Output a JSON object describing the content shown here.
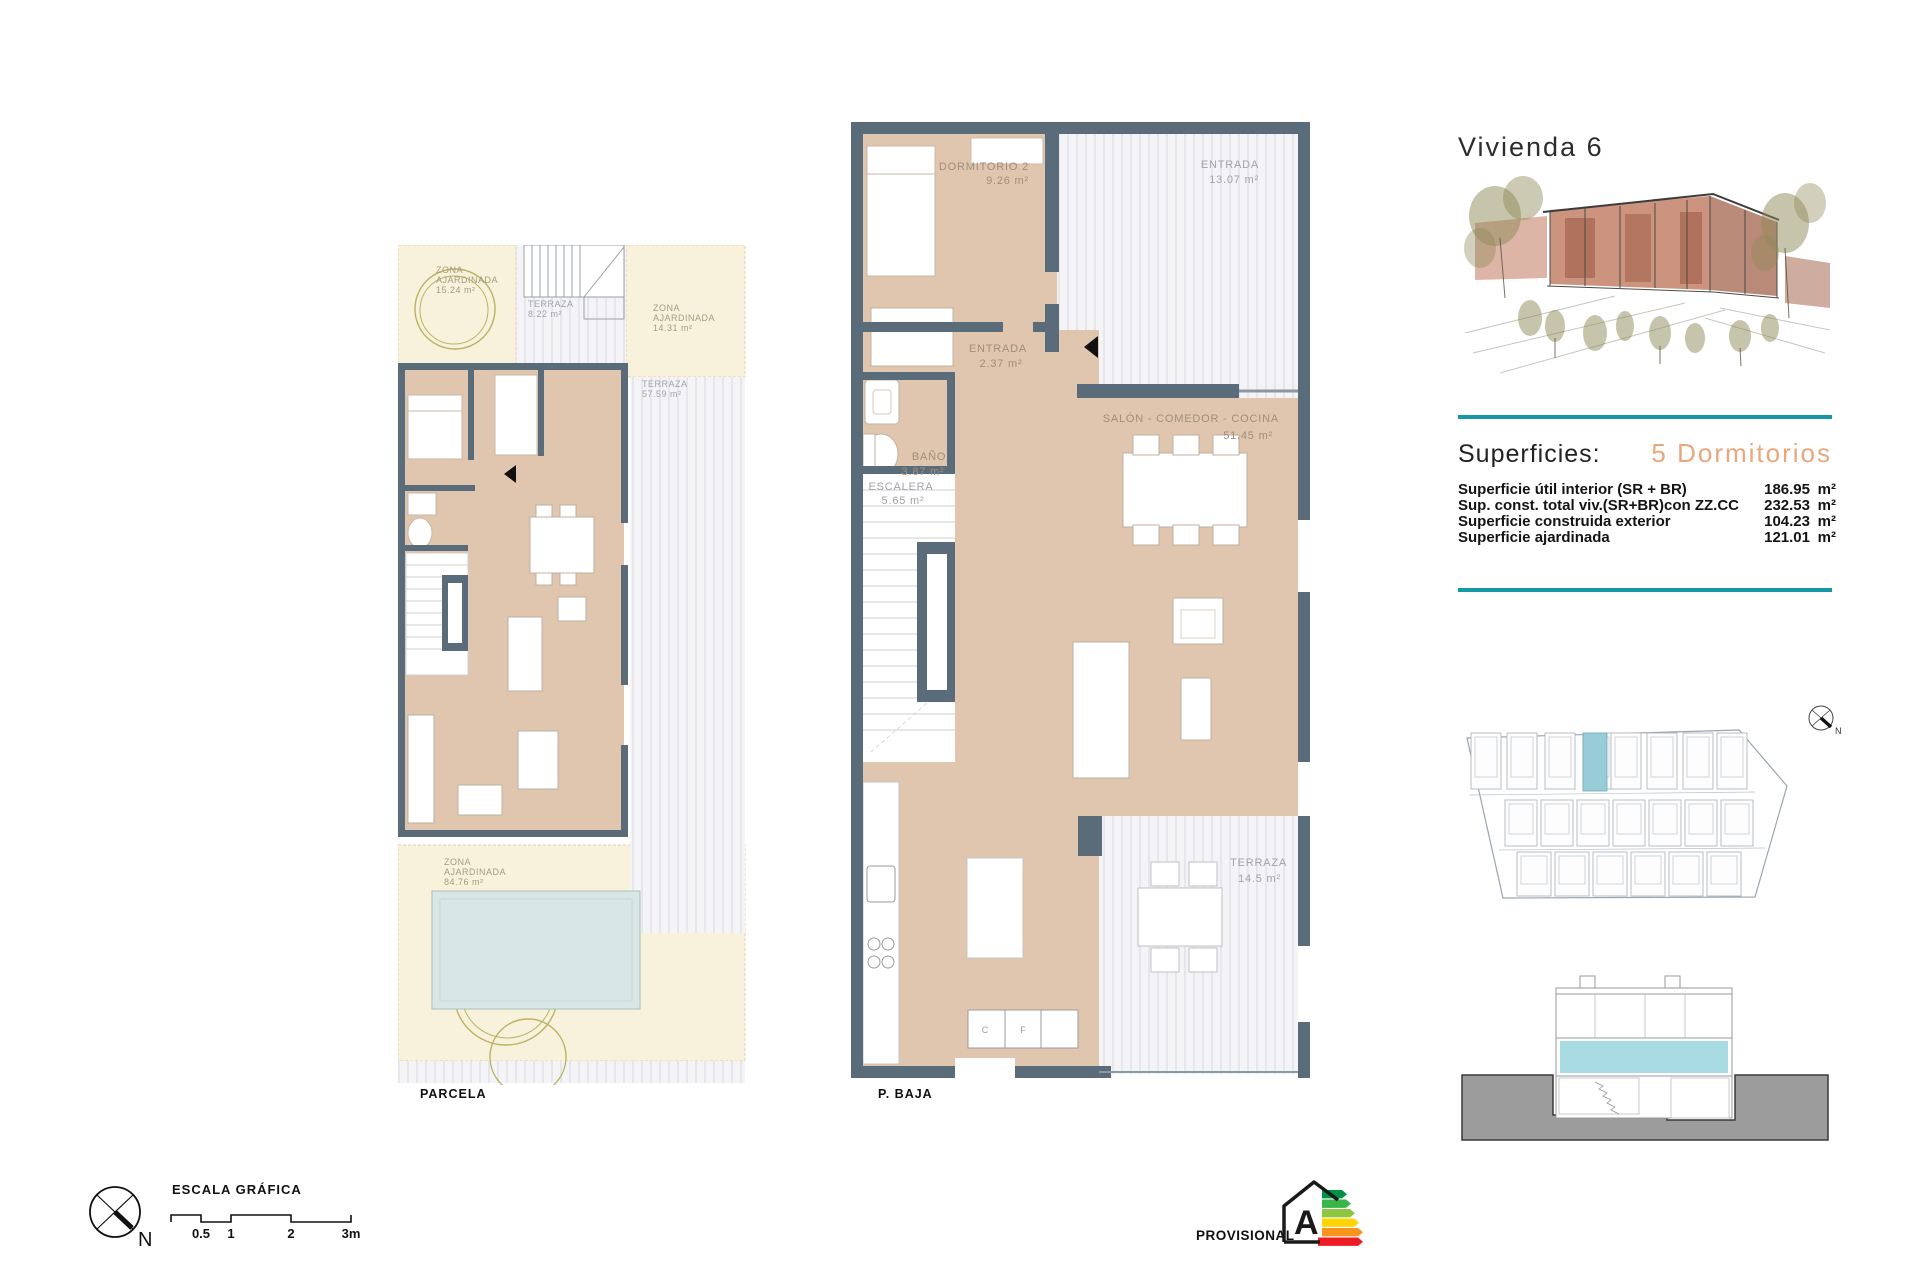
{
  "title": "Vivienda 6",
  "superficies": {
    "heading": "Superficies:",
    "subtitle": "5 Dormitorios",
    "rows": [
      {
        "label": "Superficie útil interior (SR + BR)",
        "value": "186.95",
        "unit": "m²"
      },
      {
        "label": "Sup. const. total viv.(SR+BR)con ZZ.CC",
        "value": "232.53",
        "unit": "m²"
      },
      {
        "label": "Superficie construida exterior",
        "value": "104.23",
        "unit": "m²"
      },
      {
        "label": "Superficie ajardinada",
        "value": "121.01",
        "unit": "m²"
      }
    ]
  },
  "parcela_plan": {
    "caption": "PARCELA",
    "zones": {
      "garden_top_left": {
        "l1": "ZONA",
        "l2": "AJARDINADA",
        "area": "15.24 m²"
      },
      "terraza_top": {
        "l1": "TERRAZA",
        "area": "8.22 m²"
      },
      "garden_top_right": {
        "l1": "ZONA",
        "l2": "AJARDINADA",
        "area": "14.31 m²"
      },
      "terraza_right": {
        "l1": "TERRAZA",
        "area": "57.59 m²"
      },
      "garden_bottom": {
        "l1": "ZONA",
        "l2": "AJARDINADA",
        "area": "84.76 m²"
      }
    }
  },
  "pbaja_plan": {
    "caption": "P. BAJA",
    "rooms": {
      "dormitorio2": {
        "name": "DORMITORIO 2",
        "area": "9.26 m²"
      },
      "entrada_exterior": {
        "name": "ENTRADA",
        "area": "13.07 m²"
      },
      "entrada": {
        "name": "ENTRADA",
        "area": "2.37 m²"
      },
      "bano": {
        "name": "BAÑO",
        "area": "3.87 m²"
      },
      "escalera": {
        "name": "ESCALERA",
        "area": "5.65 m²"
      },
      "salon": {
        "name": "SALÓN - COMEDOR - COCINA",
        "area": "51.45 m²"
      },
      "terraza": {
        "name": "TERRAZA",
        "area": "14.5 m²"
      },
      "kitchen_marks": {
        "c": "C",
        "f": "F"
      }
    }
  },
  "site_plan": {
    "north_label": "N"
  },
  "footer": {
    "scale_title": "ESCALA GRÁFICA",
    "scale_ticks": [
      "0.5",
      "1",
      "2",
      "3m"
    ],
    "north_label": "N",
    "provisional_label": "PROVISIONAL",
    "energy_rating": "A"
  },
  "icons": {
    "compass": "north-arrow",
    "site_compass": "north-arrow",
    "energy": "energy-rating-house",
    "door_marker": "door-direction-triangle"
  },
  "colors": {
    "accent_teal": "#1697a6",
    "subtitle_salmon": "#e9a77c",
    "wall": "#5a6c79",
    "floor_tan": "#e0c6ae",
    "garden_cream": "#f8f1dc",
    "pool_blue": "#d8e7e5",
    "site_highlight": "#99ccd9",
    "section_blue": "#a9dbe3",
    "section_ground": "#9c9c9c",
    "energy_bars": [
      "#009245",
      "#39b54a",
      "#8dc63f",
      "#ffd400",
      "#f7941e",
      "#ed1c24"
    ]
  }
}
